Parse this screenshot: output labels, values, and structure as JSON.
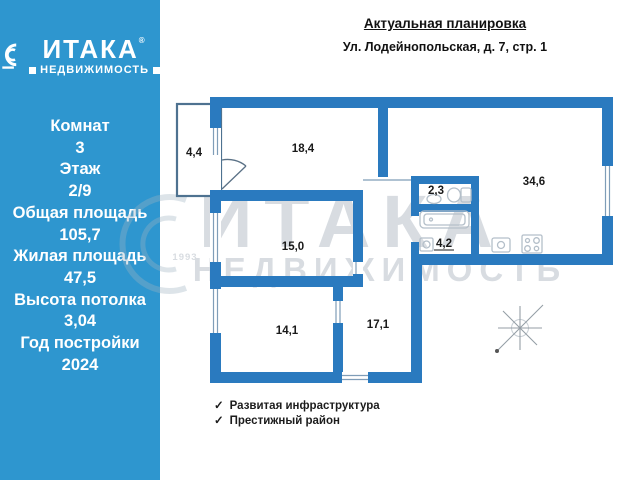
{
  "header": {
    "title": "Актуальная планировка",
    "address": "Ул. Лодейнопольская, д. 7, стр. 1"
  },
  "sidebar": {
    "background_color": "#2e96cf",
    "logo": {
      "name": "ИТАКА",
      "reg": "®",
      "subtitle": "НЕДВИЖИМОСТЬ"
    },
    "stats": [
      {
        "label": "Комнат",
        "value": "3"
      },
      {
        "label": "Этаж",
        "value": "2/9"
      },
      {
        "label": "Общая площадь",
        "value": "105,7"
      },
      {
        "label": "Жилая площадь",
        "value": "47,5"
      },
      {
        "label": "Высота потолка",
        "value": "3,04"
      },
      {
        "label": "Год постройки",
        "value": "2024"
      }
    ]
  },
  "plan": {
    "wall_color": "#2a7abf",
    "rooms": [
      {
        "name": "balcony",
        "area": "4,4"
      },
      {
        "name": "room-18",
        "area": "18,4"
      },
      {
        "name": "kitchen-living",
        "area": "34,6"
      },
      {
        "name": "wc",
        "area": "2,3"
      },
      {
        "name": "bathroom",
        "area": "4,2"
      },
      {
        "name": "hall",
        "area": "15,0"
      },
      {
        "name": "room-14",
        "area": "14,1"
      },
      {
        "name": "room-17",
        "area": "17,1"
      }
    ]
  },
  "features": [
    {
      "icon": "✓",
      "text": "Развитая инфраструктура"
    },
    {
      "icon": "✓",
      "text": "Престижный район"
    }
  ],
  "watermark": {
    "brand": "ИТАКА",
    "reg": "®",
    "subtitle": "НЕДВИЖИМОСТЬ",
    "year": "1993"
  }
}
